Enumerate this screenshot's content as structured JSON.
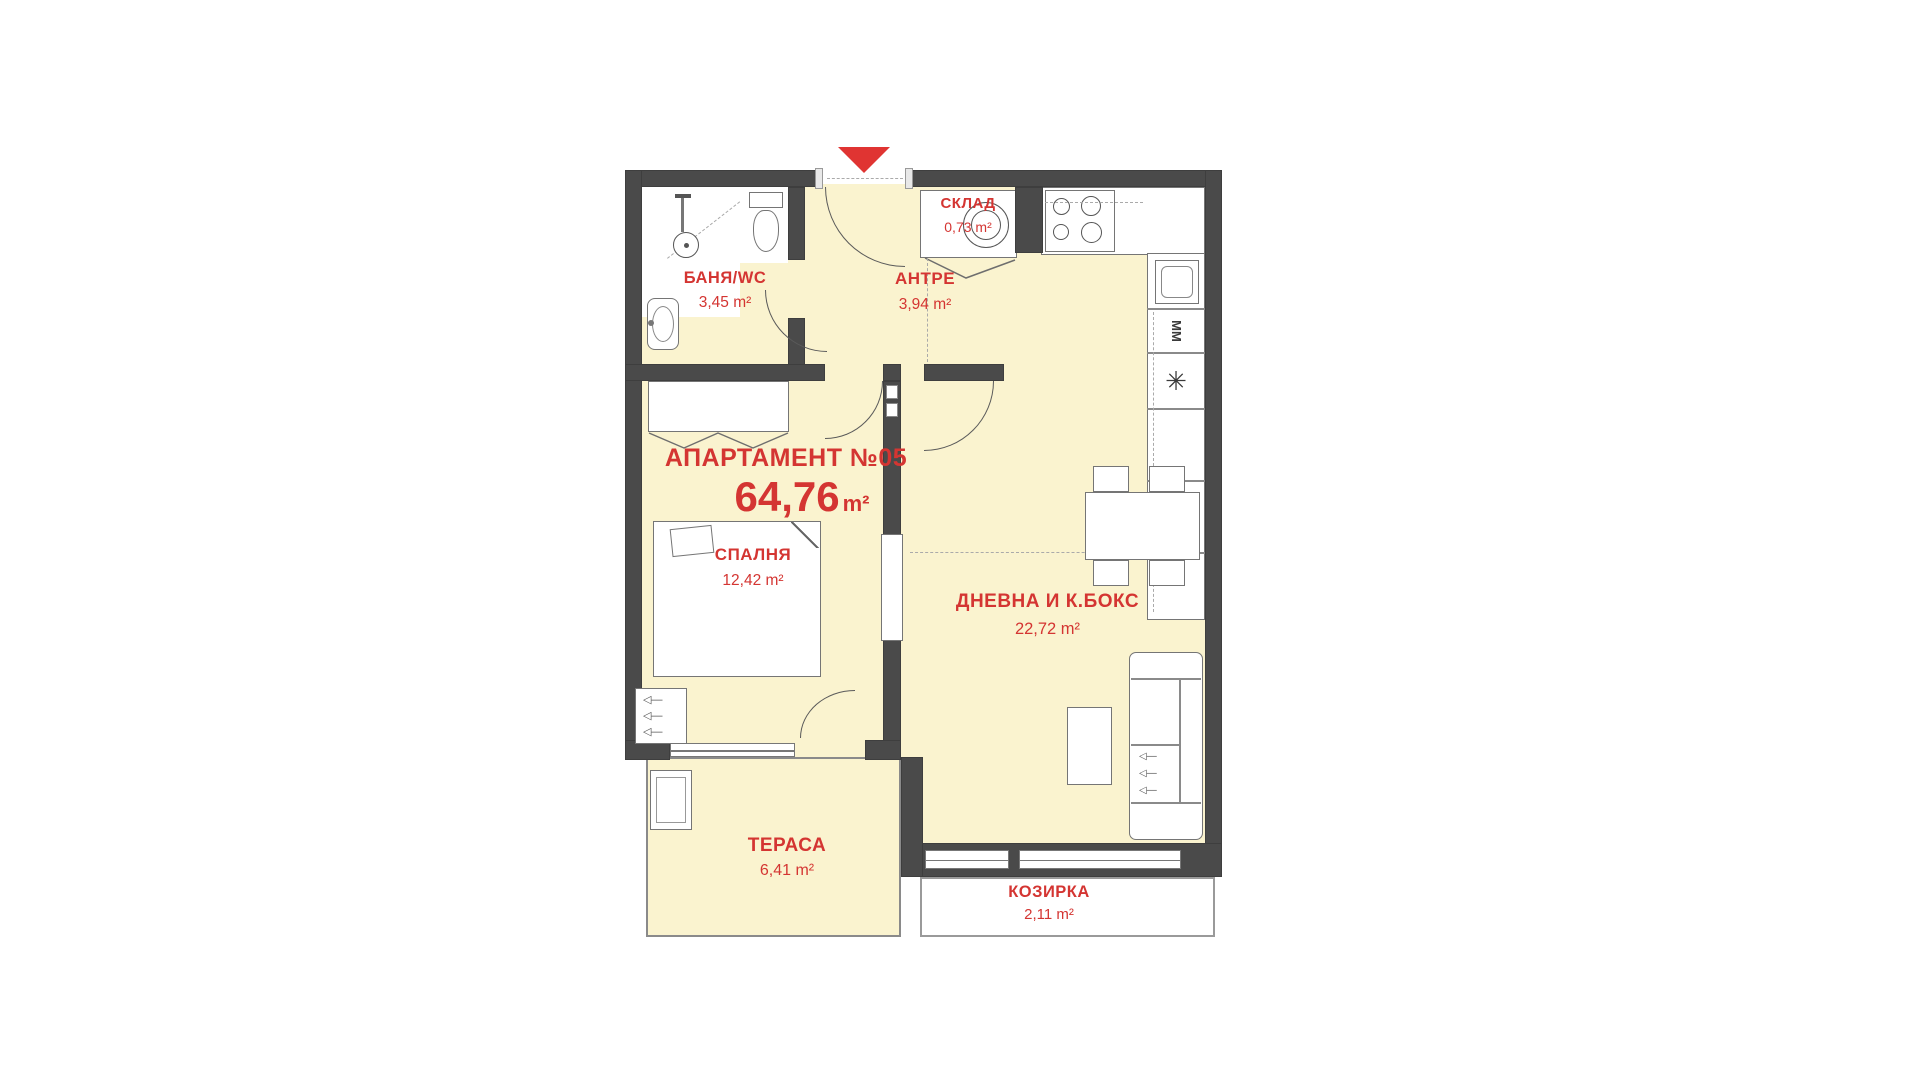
{
  "plan": {
    "title": "АПАРТАМЕНТ №05",
    "total_area": {
      "value": "64,76",
      "unit": "m²"
    },
    "colors": {
      "floor": "#FAF3CF",
      "wall": "#4A4A4A",
      "accent": "#D43532",
      "white": "#FFFFFF"
    },
    "rooms": [
      {
        "name": "БАНЯ/WC",
        "area": "3,45 m²"
      },
      {
        "name": "АНТРЕ",
        "area": "3,94 m²"
      },
      {
        "name": "СКЛАД",
        "area": "0,73 m²"
      },
      {
        "name": "СПАЛНЯ",
        "area": "12,42 m²"
      },
      {
        "name": "ДНЕВНА И К.БОКС",
        "area": "22,72 m²"
      },
      {
        "name": "ТЕРАСА",
        "area": "6,41 m²"
      },
      {
        "name": "КОЗИРКА",
        "area": "2,11 m²"
      }
    ],
    "labels": {
      "washing_machine": "ММ",
      "appliance_symbol": "✳"
    }
  }
}
